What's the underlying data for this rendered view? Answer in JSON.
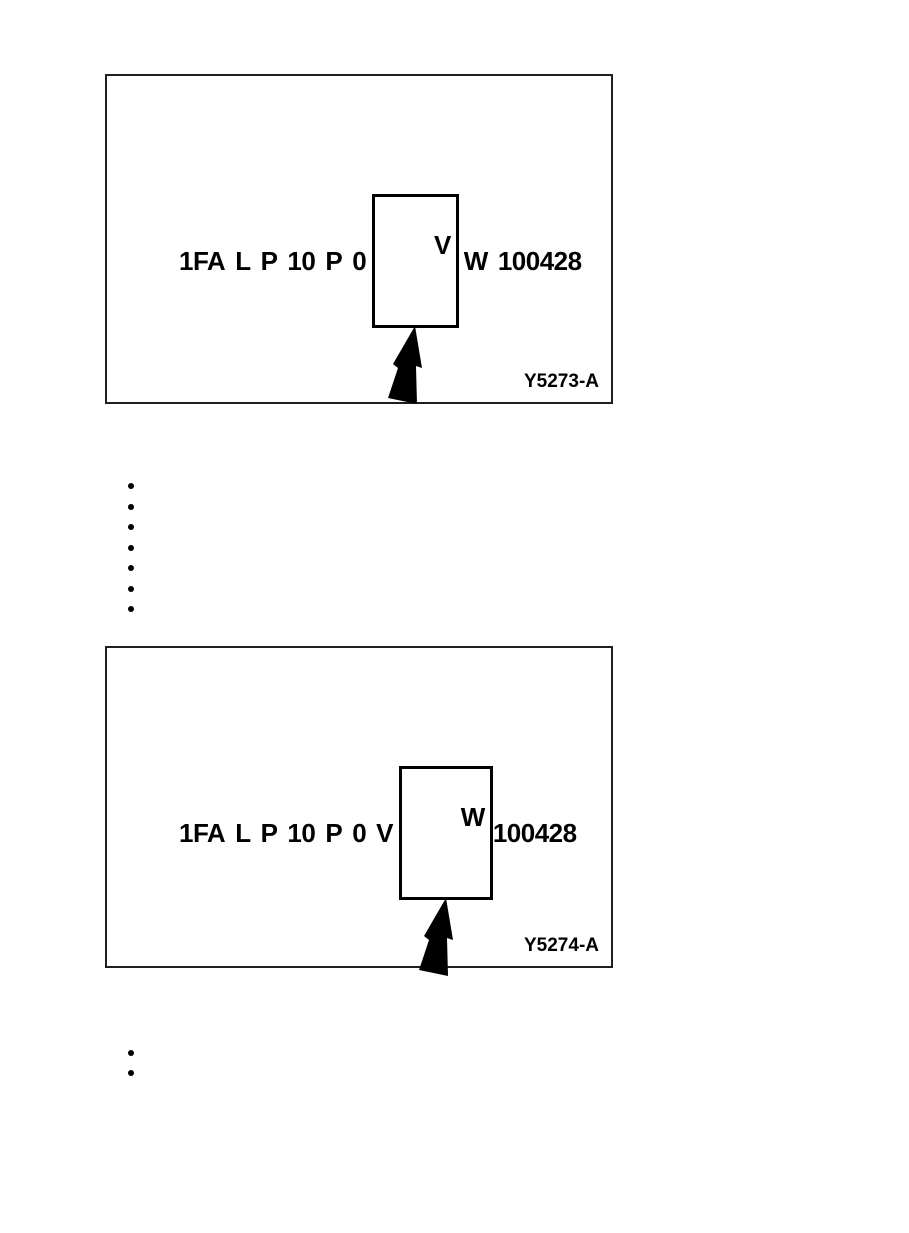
{
  "page": {
    "background": "#ffffff",
    "ink_color": "#000000"
  },
  "figures": [
    {
      "label": "Y5273-A",
      "vin_segments": [
        "1FA",
        "L",
        "P",
        "10",
        "P",
        "0",
        "V",
        "W",
        "100428"
      ],
      "highlighted_segment": "V",
      "highlighted_index": 6
    },
    {
      "label": "Y5274-A",
      "vin_segments": [
        "1FA",
        "L",
        "P",
        "10",
        "P",
        "0",
        "V",
        "W",
        "100428"
      ],
      "highlighted_segment": "W",
      "highlighted_index": 7
    }
  ],
  "bullet_lists": [
    {
      "count": 7,
      "items": [
        "",
        "",
        "",
        "",
        "",
        "",
        ""
      ]
    },
    {
      "count": 2,
      "items": [
        "",
        ""
      ]
    }
  ],
  "icons": {
    "pointer_arrow": "black-up-pointer-arrow"
  }
}
